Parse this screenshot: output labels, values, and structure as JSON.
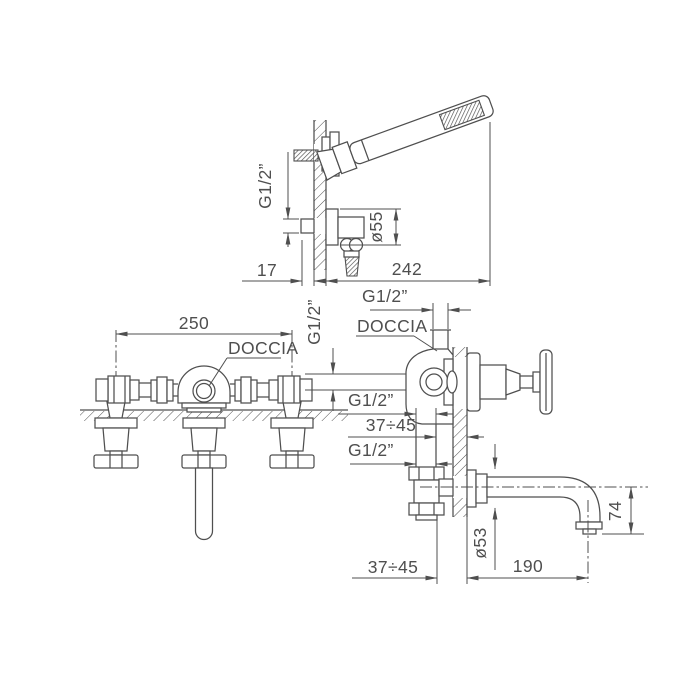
{
  "drawing_type": "bath mixer with hand shower - dimensioned technical drawing",
  "colors": {
    "line": "#4f4f4f",
    "background": "#ffffff"
  },
  "labels": {
    "hand_shower": {
      "thread": "G1/2”",
      "flange_dia": "ø55",
      "offset": "17",
      "length": "242"
    },
    "front_view": {
      "spacing": "250",
      "doccia": "DOCCIA"
    },
    "side_view": {
      "thread_top": "G1/2”",
      "doccia": "DOCCIA",
      "thread_side": "G1/2”",
      "thread_mid": "G1/2”",
      "depth_upper": "37÷45",
      "thread_low": "G1/2”",
      "flange_dia": "ø53",
      "depth_lower": "37÷45",
      "projection": "190",
      "drop": "74"
    }
  }
}
